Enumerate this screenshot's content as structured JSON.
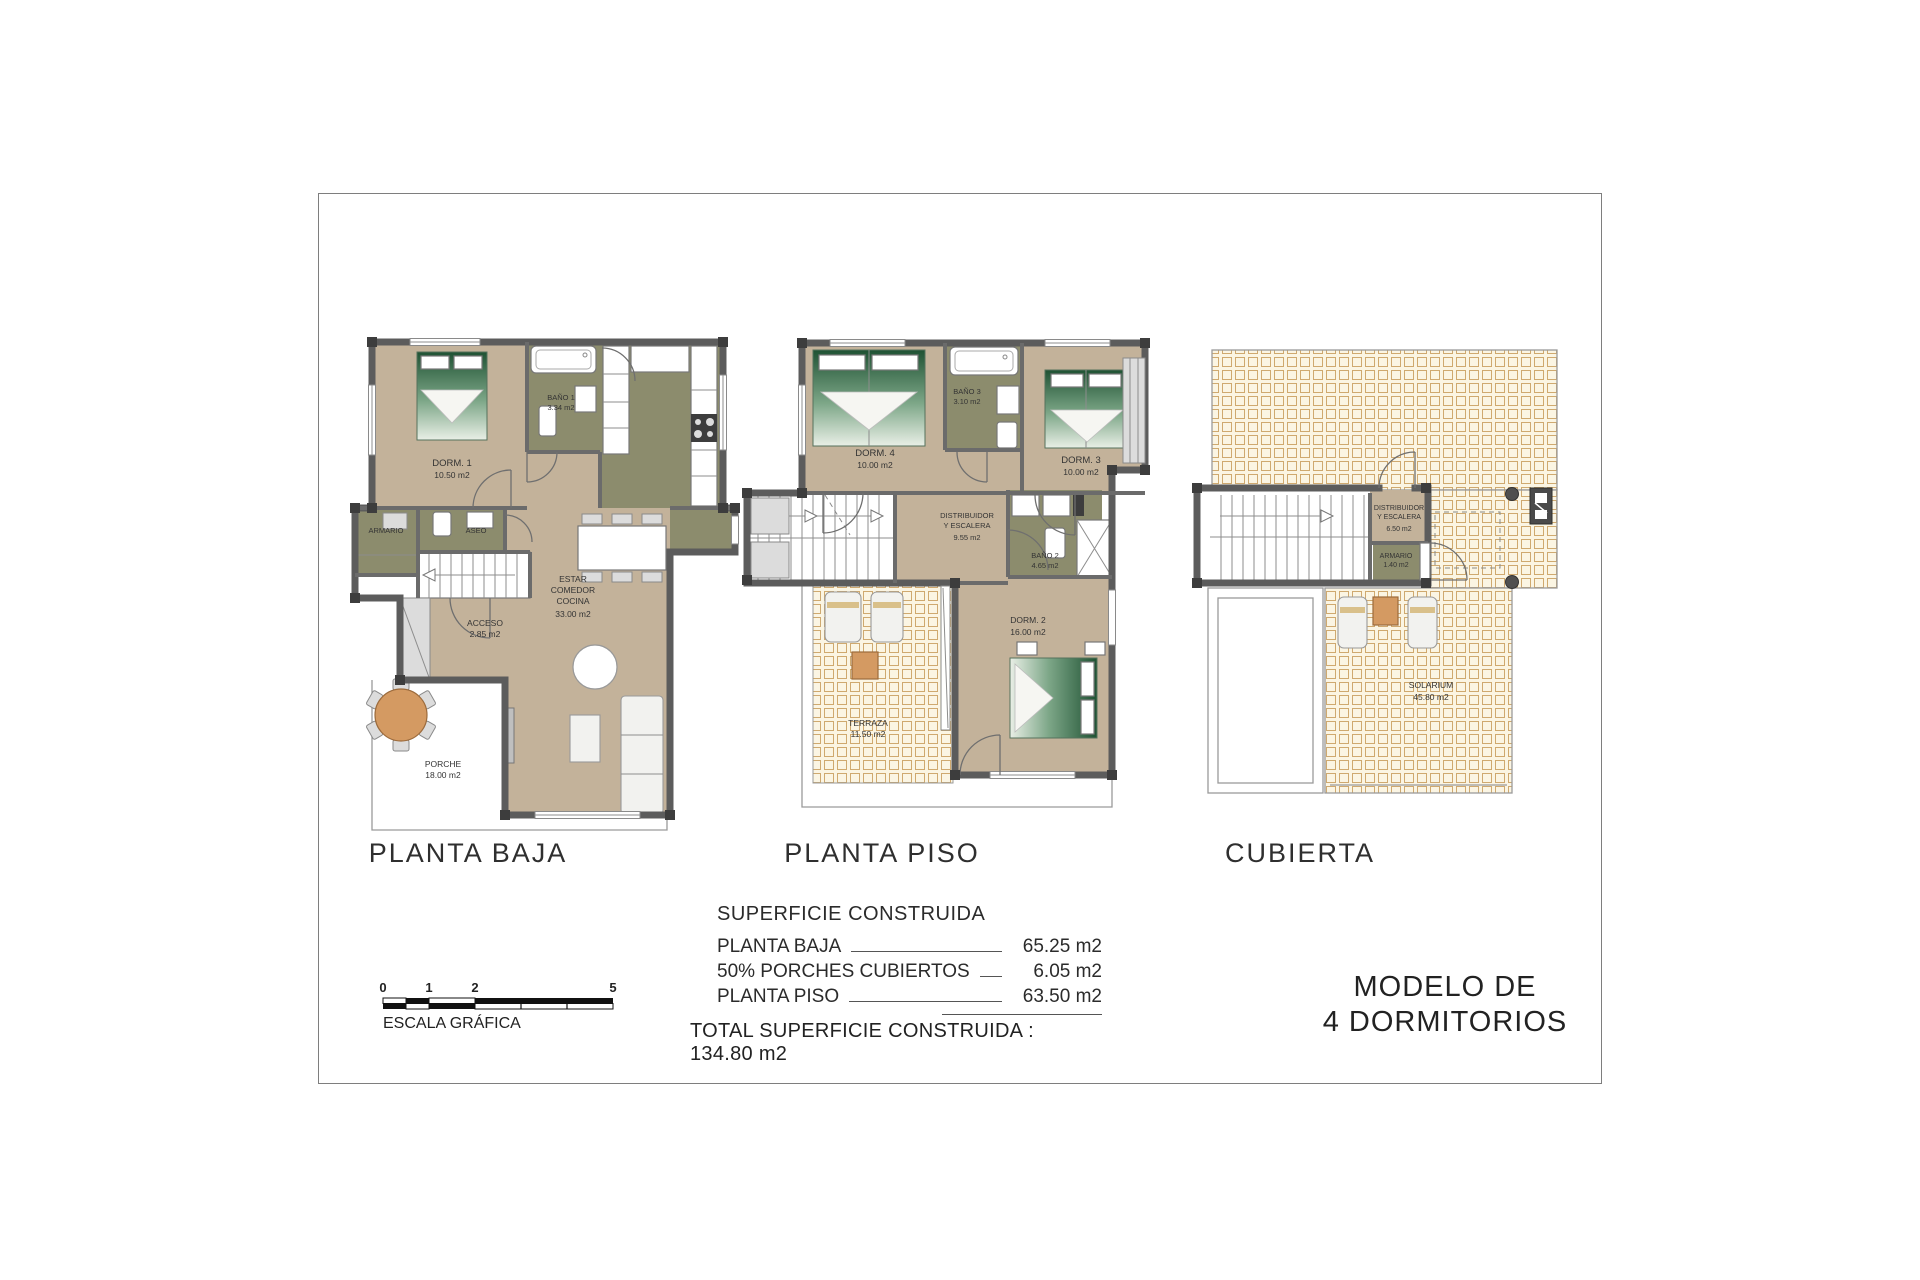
{
  "colors": {
    "wall": "#5c5c5c",
    "floor_tan": "#c3b29a",
    "wet_room_olive": "#8c8c6d",
    "tile_cream": "#fbf5e3",
    "tile_line": "#cfa96f",
    "wood_orange": "#d49a62",
    "bed_green": "#1f5233"
  },
  "plans": {
    "planta_baja": {
      "title": "PLANTA BAJA",
      "rooms": [
        {
          "id": "dorm1",
          "lines": [
            "DORM. 1",
            "10.50 m2"
          ]
        },
        {
          "id": "bano1",
          "lines": [
            "BAÑO 1",
            "3.34 m2"
          ]
        },
        {
          "id": "armario",
          "lines": [
            "ARMARIO"
          ]
        },
        {
          "id": "aseo",
          "lines": [
            "ASEO"
          ]
        },
        {
          "id": "acceso",
          "lines": [
            "ACCESO",
            "2.85 m2"
          ]
        },
        {
          "id": "estar",
          "lines": [
            "ESTAR",
            "COMEDOR",
            "COCINA",
            "33.00 m2"
          ]
        },
        {
          "id": "porche",
          "lines": [
            "PORCHE",
            "18.00 m2"
          ]
        }
      ]
    },
    "planta_piso": {
      "title": "PLANTA PISO",
      "rooms": [
        {
          "id": "dorm4",
          "lines": [
            "DORM. 4",
            "10.00 m2"
          ]
        },
        {
          "id": "bano3",
          "lines": [
            "BAÑO 3",
            "3.10 m2"
          ]
        },
        {
          "id": "dorm3",
          "lines": [
            "DORM. 3",
            "10.00 m2"
          ]
        },
        {
          "id": "distribuidor",
          "lines": [
            "DISTRIBUIDOR",
            "Y ESCALERA",
            "9.55 m2"
          ]
        },
        {
          "id": "bano2",
          "lines": [
            "BAÑO 2",
            "4.65 m2"
          ]
        },
        {
          "id": "dorm2",
          "lines": [
            "DORM. 2",
            "16.00 m2"
          ]
        },
        {
          "id": "terraza",
          "lines": [
            "TERRAZA",
            "11.50 m2"
          ]
        }
      ]
    },
    "cubierta": {
      "title": "CUBIERTA",
      "rooms": [
        {
          "id": "distribuidor",
          "lines": [
            "DISTRIBUIDOR",
            "Y ESCALERA",
            "6.50 m2"
          ]
        },
        {
          "id": "armario",
          "lines": [
            "ARMARIO",
            "1.40 m2"
          ]
        },
        {
          "id": "solarium",
          "lines": [
            "SOLARIUM",
            "45.80 m2"
          ]
        }
      ]
    }
  },
  "surface_table": {
    "title": "SUPERFICIE CONSTRUIDA",
    "rows": [
      {
        "label": "PLANTA BAJA",
        "value": "65.25 m2"
      },
      {
        "label": "50% PORCHES CUBIERTOS",
        "value": "6.05 m2"
      },
      {
        "label": "PLANTA PISO",
        "value": "63.50 m2"
      }
    ],
    "total": "TOTAL SUPERFICIE CONSTRUIDA : 134.80 m2"
  },
  "scale": {
    "label": "ESCALA GRÁFICA",
    "ticks": [
      "0",
      "1",
      "2",
      "5"
    ]
  },
  "model": {
    "line1": "MODELO DE",
    "line2": "4 DORMITORIOS"
  }
}
